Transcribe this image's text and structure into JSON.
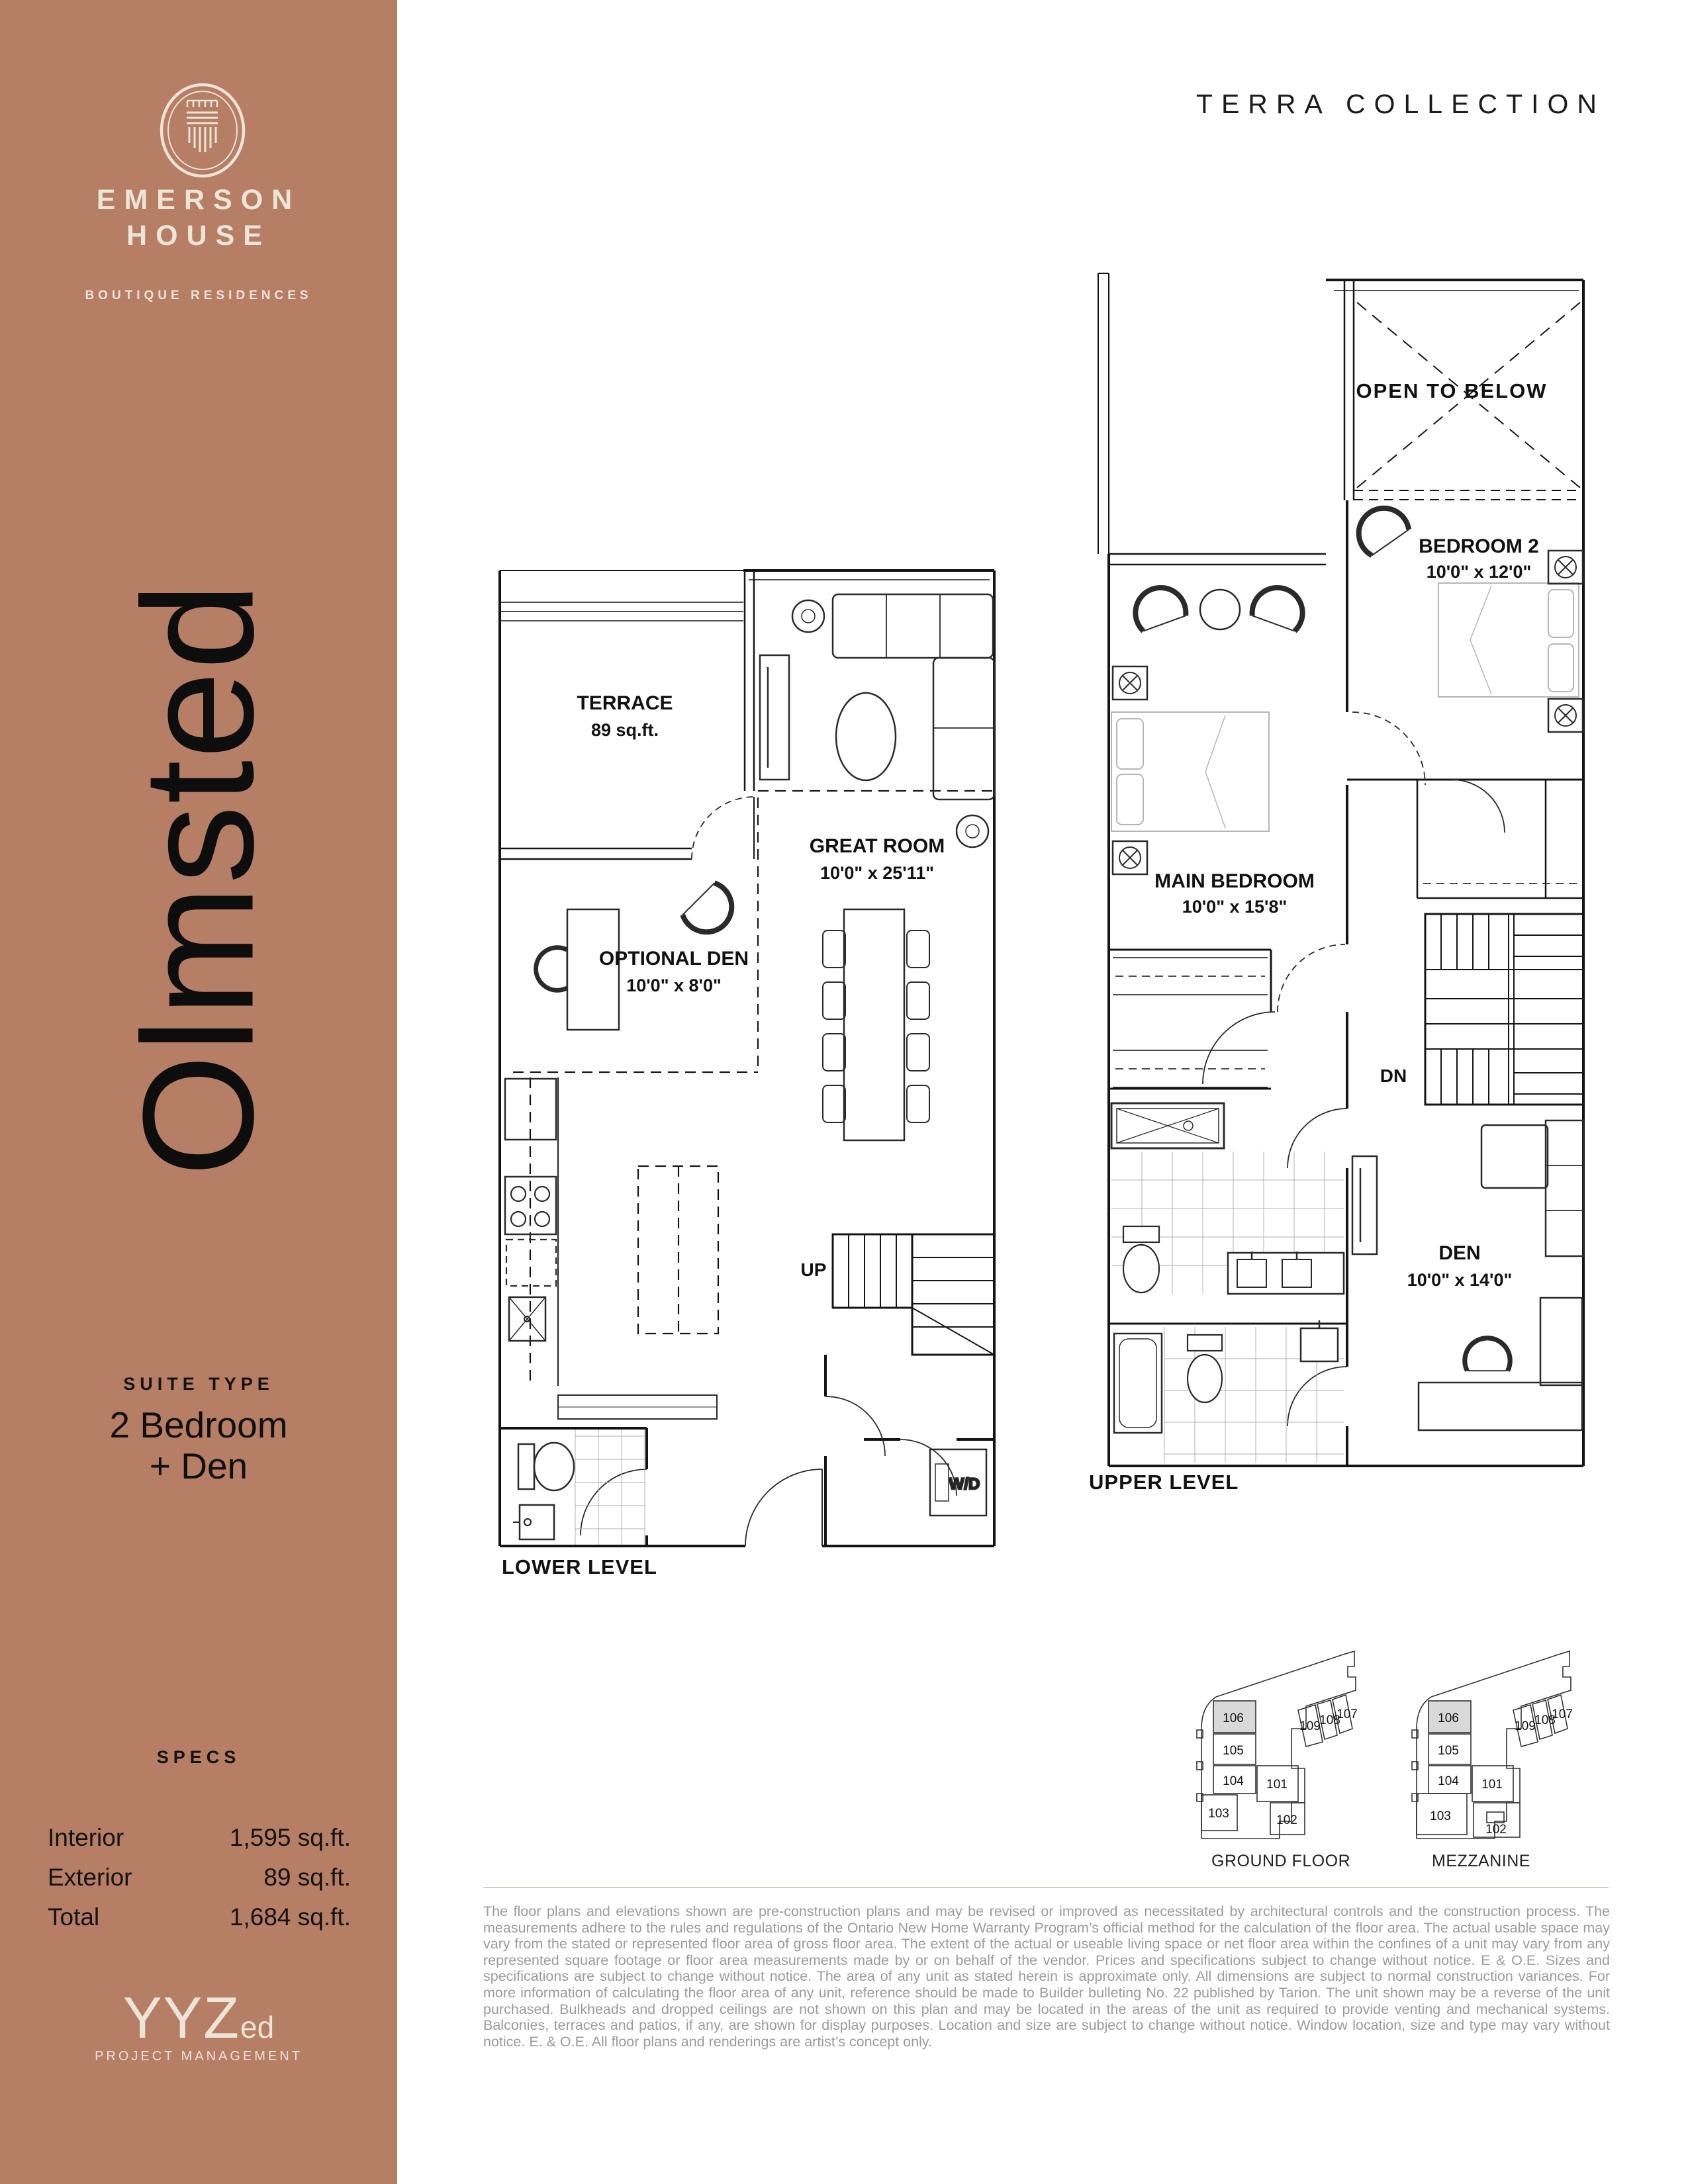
{
  "colors": {
    "sidebar_bg": "#b57e65",
    "cream": "#ece5d8",
    "ink": "#111111",
    "disclaimer_gray": "#9b9b9b",
    "plan_line": "#141414",
    "keyplan_highlight": "#d9d9d9"
  },
  "sidebar": {
    "logo": "emerson-crest-icon",
    "brand_line1": "EMERSON",
    "brand_line2": "HOUSE",
    "tagline": "BOUTIQUE RESIDENCES",
    "suite_name": "Olmsted",
    "suite_type_heading": "SUITE TYPE",
    "suite_type_line1": "2 Bedroom",
    "suite_type_line2": "+ Den",
    "specs_heading": "SPECS",
    "specs": [
      {
        "label": "Interior",
        "value": "1,595 sq.ft."
      },
      {
        "label": "Exterior",
        "value": "89 sq.ft."
      },
      {
        "label": "Total",
        "value": "1,684 sq.ft."
      }
    ],
    "footer_brand": {
      "main": "YYZ",
      "suffix": "ed",
      "subtitle": "PROJECT MANAGEMENT"
    }
  },
  "header": {
    "collection": "TERRA COLLECTION"
  },
  "plans": {
    "lower": {
      "level_label": "LOWER LEVEL",
      "terrace": {
        "label": "TERRACE",
        "dims": "89 sq.ft."
      },
      "great_room": {
        "label": "GREAT ROOM",
        "dims": "10'0\" x 25'11\""
      },
      "optional_den": {
        "label": "OPTIONAL DEN",
        "dims": "10'0\" x 8'0\""
      },
      "up_label": "UP",
      "wd_label": "W/D"
    },
    "upper": {
      "level_label": "UPPER LEVEL",
      "open_to_below": {
        "label": "OPEN TO BELOW"
      },
      "bedroom2": {
        "label": "BEDROOM 2",
        "dims": "10'0\" x 12'0\""
      },
      "main_bedroom": {
        "label": "MAIN BEDROOM",
        "dims": "10'0\" x 15'8\""
      },
      "den": {
        "label": "DEN",
        "dims": "10'0\" x 14'0\""
      },
      "dn_label": "DN"
    }
  },
  "keyplans": {
    "highlighted_unit": "106",
    "ground": {
      "label": "GROUND FLOOR",
      "units": [
        "106",
        "105",
        "104",
        "103",
        "101",
        "102",
        "109",
        "108",
        "107"
      ]
    },
    "mezzanine": {
      "label": "MEZZANINE",
      "units": [
        "106",
        "105",
        "104",
        "103",
        "101",
        "102",
        "109",
        "108",
        "107"
      ]
    }
  },
  "disclaimer": "The floor plans and elevations shown are pre-construction plans and may be revised or improved as necessitated by architectural controls and the construction process. The measurements adhere to the rules and regulations of the Ontario New Home Warranty Program’s official method for the calculation of the floor area. The actual usable space may vary from the stated or represented floor area of gross floor area. The extent of the actual or useable living space or net floor area within the confines of a unit may vary from any represented square footage or floor area measurements made by or on behalf of the vendor. Prices and specifications subject to change without notice. E & O.E. Sizes and specifications are subject to change without notice. The area of any unit as stated herein is approximate only. All dimensions are subject to normal construction variances. For more information of calculating the floor area of any unit, reference should be made to Builder bulleting No. 22 published by Tarion. The unit shown may be a reverse of the unit purchased. Bulkheads and dropped ceilings are not shown on this plan and may be located in the areas of the unit as required to provide venting and mechanical systems. Balconies, terraces and patios, if any, are shown for display purposes. Location and size are subject to change without notice. Window location, size and type may vary without notice. E. & O.E. All floor plans and renderings are artist’s concept only."
}
